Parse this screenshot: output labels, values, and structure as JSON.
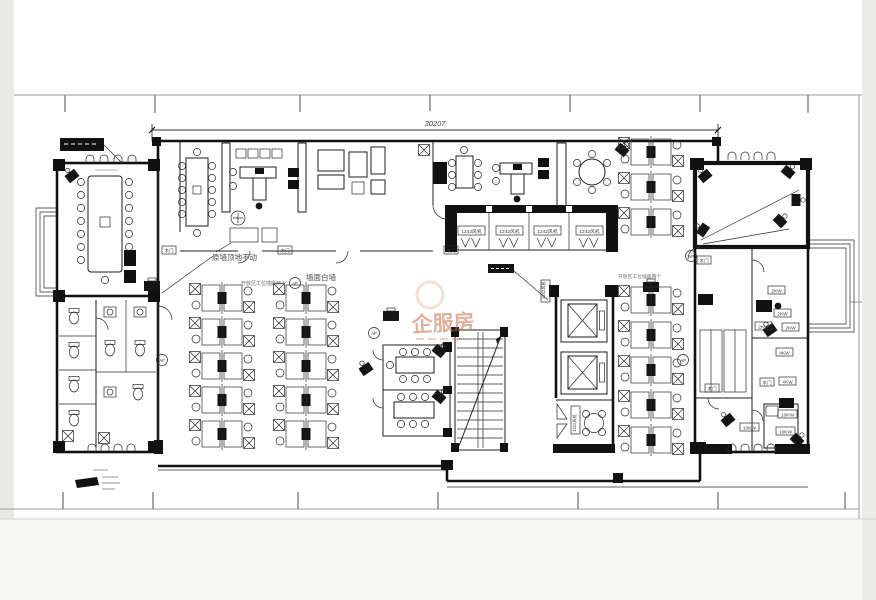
{
  "sheet": {
    "dimension_top": "30207"
  },
  "notes": {
    "wall_fixed": "原墙顶地不动",
    "white_wall": "墙面白墙",
    "sockets_left": "开放区工位插座两个",
    "sockets_right": "开放区工位插座两个"
  },
  "tags": {
    "fcu": "1242风机",
    "door": "木门",
    "ap": "AP"
  },
  "power": [
    "2KW",
    "2KW",
    "2KW",
    "2KW",
    "4KW",
    "4KW",
    "10KW",
    "10KW",
    "10KW"
  ],
  "watermark": {
    "text": "企服房"
  },
  "colors": {
    "ink": "#1c1c1c",
    "watermark": "#c4724d"
  }
}
